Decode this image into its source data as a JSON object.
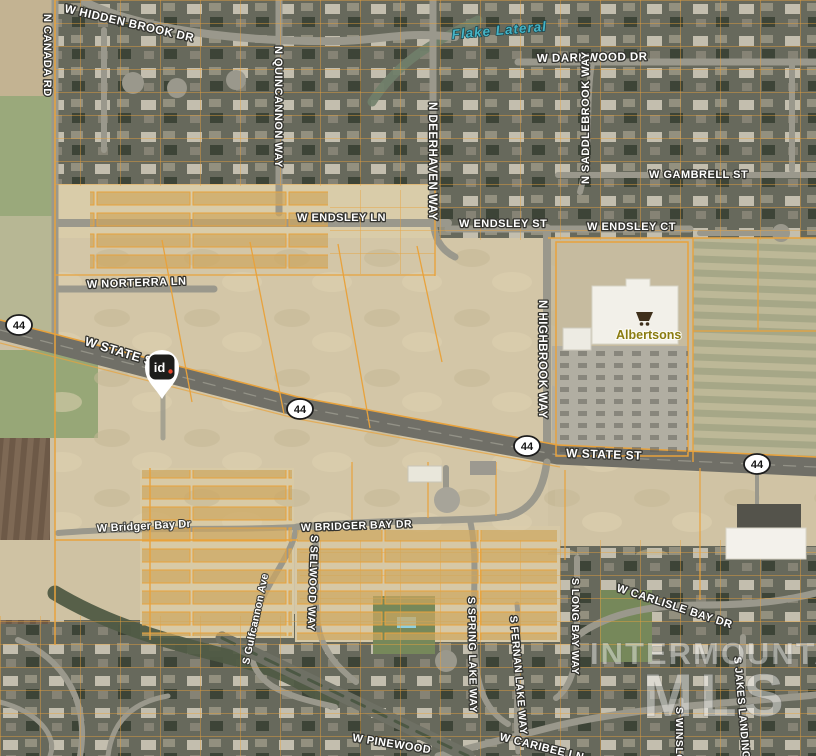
{
  "watermark": {
    "line1": "INTERMOUNTAIN",
    "line2": "MLS"
  },
  "marker": {
    "label": "id"
  },
  "highway_shields": [
    "44",
    "44",
    "44",
    "44"
  ],
  "water_feature": {
    "label": "Flake Lateral"
  },
  "poi": {
    "grocery_store": {
      "label": "Albertsons"
    }
  },
  "street_labels": [
    {
      "text": "W HIDDEN BROOK DR"
    },
    {
      "text": "N CANADA RD"
    },
    {
      "text": "W DARKWOOD DR"
    },
    {
      "text": "N QUINCANNON WAY"
    },
    {
      "text": "N DEERHAVEN WAY"
    },
    {
      "text": "N SADDLEBROOK WAY"
    },
    {
      "text": "W GAMBRELL ST"
    },
    {
      "text": "W ENDSLEY LN"
    },
    {
      "text": "W ENDSLEY ST"
    },
    {
      "text": "W ENDSLEY CT"
    },
    {
      "text": "W NORTERRA LN"
    },
    {
      "text": "W STATE ST"
    },
    {
      "text": "W STATE ST"
    },
    {
      "text": "N HIGHBROOK WAY"
    },
    {
      "text": "W Bridger Bay Dr"
    },
    {
      "text": "W BRIDGER BAY DR"
    },
    {
      "text": "S Gulfcannon Ave"
    },
    {
      "text": "S SELWOOD WAY"
    },
    {
      "text": "S SPRING LAKE WAY"
    },
    {
      "text": "S FERNAN LAKE WAY"
    },
    {
      "text": "S LONG BAY WAY"
    },
    {
      "text": "W CARLISLE BAY DR"
    },
    {
      "text": "S JAKES LANDING WAY"
    },
    {
      "text": "S WINSLOW"
    },
    {
      "text": "W CARIBEE LN"
    },
    {
      "text": "W PINEWOOD"
    }
  ],
  "colors": {
    "parcel_line": "#e8a23c",
    "marker_dot": "#e8452c",
    "marker_bg": "#1d1d1b",
    "water_label": "#46b4c6",
    "poi_label": "#8a7b10",
    "highway_road": "#706f67",
    "dirt": "#d3c6a7"
  }
}
